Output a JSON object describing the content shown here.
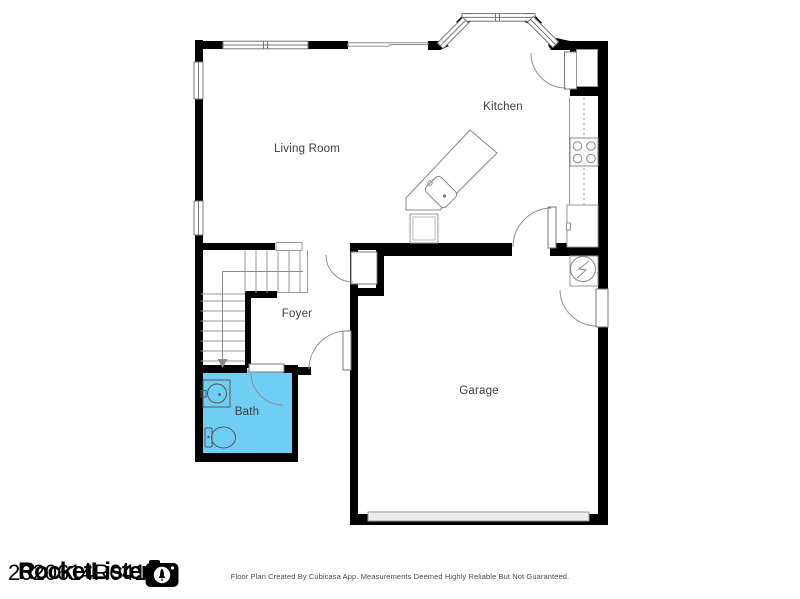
{
  "floor_plan": {
    "rooms": [
      {
        "label": "Living Room"
      },
      {
        "label": "Kitchen"
      },
      {
        "label": "Foyer"
      },
      {
        "label": "Bath"
      },
      {
        "label": "Garage"
      }
    ]
  },
  "watermark": {
    "brand": "RocketLister",
    "id_text": "2020614R04148",
    "camera_icon": "rocket-camera-icon"
  },
  "footer": {
    "disclaimer": "Floor Plan Created By Cubicasa App. Measurements Deemed Highly Reliable But Not Guaranteed."
  },
  "colors": {
    "wall": "#000000",
    "bath_fill": "#6FCEF4",
    "fixture_line": "#8F8F8F",
    "garage_door_fill": "#EDEDED",
    "label_text": "#3C3C3C",
    "footer_text": "#4A4A4A",
    "watermark_text": "#000000"
  }
}
